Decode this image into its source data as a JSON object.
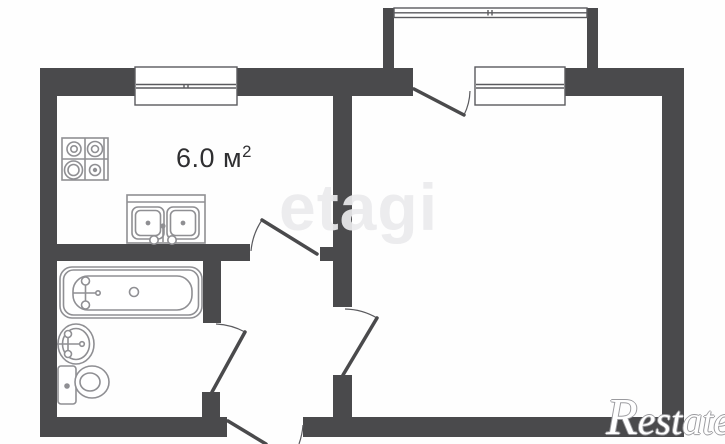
{
  "page": {
    "type": "apartment-floorplan"
  },
  "labels": {
    "kitchen_area": "6.0 м",
    "kitchen_area_exp": "2"
  },
  "watermarks": {
    "center": "etagi",
    "corner": "Restate"
  },
  "rooms": [
    {
      "id": "kitchen",
      "area_label": "6.0 м²"
    },
    {
      "id": "main-room"
    },
    {
      "id": "bathroom"
    },
    {
      "id": "hallway"
    },
    {
      "id": "balcony"
    }
  ],
  "fixtures": [
    "stove",
    "kitchen-sink",
    "bathtub",
    "washbasin",
    "toilet"
  ],
  "windows": [
    "kitchen-window",
    "room-window",
    "balcony-window"
  ],
  "doors": [
    "kitchen-door",
    "bathroom-door",
    "room-door",
    "balcony-door",
    "entrance-door"
  ],
  "colors": {
    "wall": "#4a4a4c",
    "window_stroke": "#5a5a5e",
    "fixture_stroke": "#8f8f93",
    "arc_stroke": "#5a5a5e",
    "area_text": "#2f2f31",
    "watermark_center": "#ebebed",
    "watermark_corner_fill": "#ffffff",
    "watermark_corner_outline": "#9a9a9e",
    "background": "#fefefe"
  }
}
